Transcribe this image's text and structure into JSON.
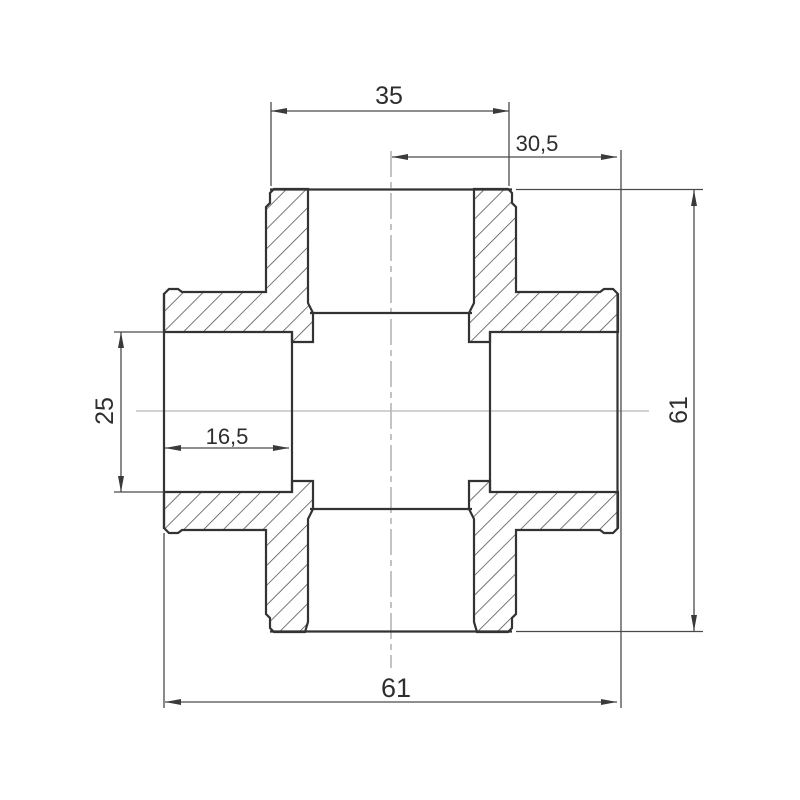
{
  "drawing": {
    "kind": "cross-pipe-fitting-section-view",
    "dimensions": {
      "top_socket_width": {
        "label": "35",
        "value": 35
      },
      "center_to_right_mouth": {
        "label": "30,5",
        "value": 30.5
      },
      "left_bore_diameter": {
        "label": "25",
        "value": 25
      },
      "left_socket_depth": {
        "label": "16,5",
        "value": 16.5
      },
      "overall_height": {
        "label": "61",
        "value": 61
      },
      "overall_width": {
        "label": "61",
        "value": 61
      }
    },
    "colors": {
      "outline": "#333333",
      "hatch": "#4a4a4a",
      "dimension_lines": "#4a4a4a",
      "text": "#2e2e2e",
      "centerline": "#ababab",
      "background": "#ffffff"
    }
  }
}
